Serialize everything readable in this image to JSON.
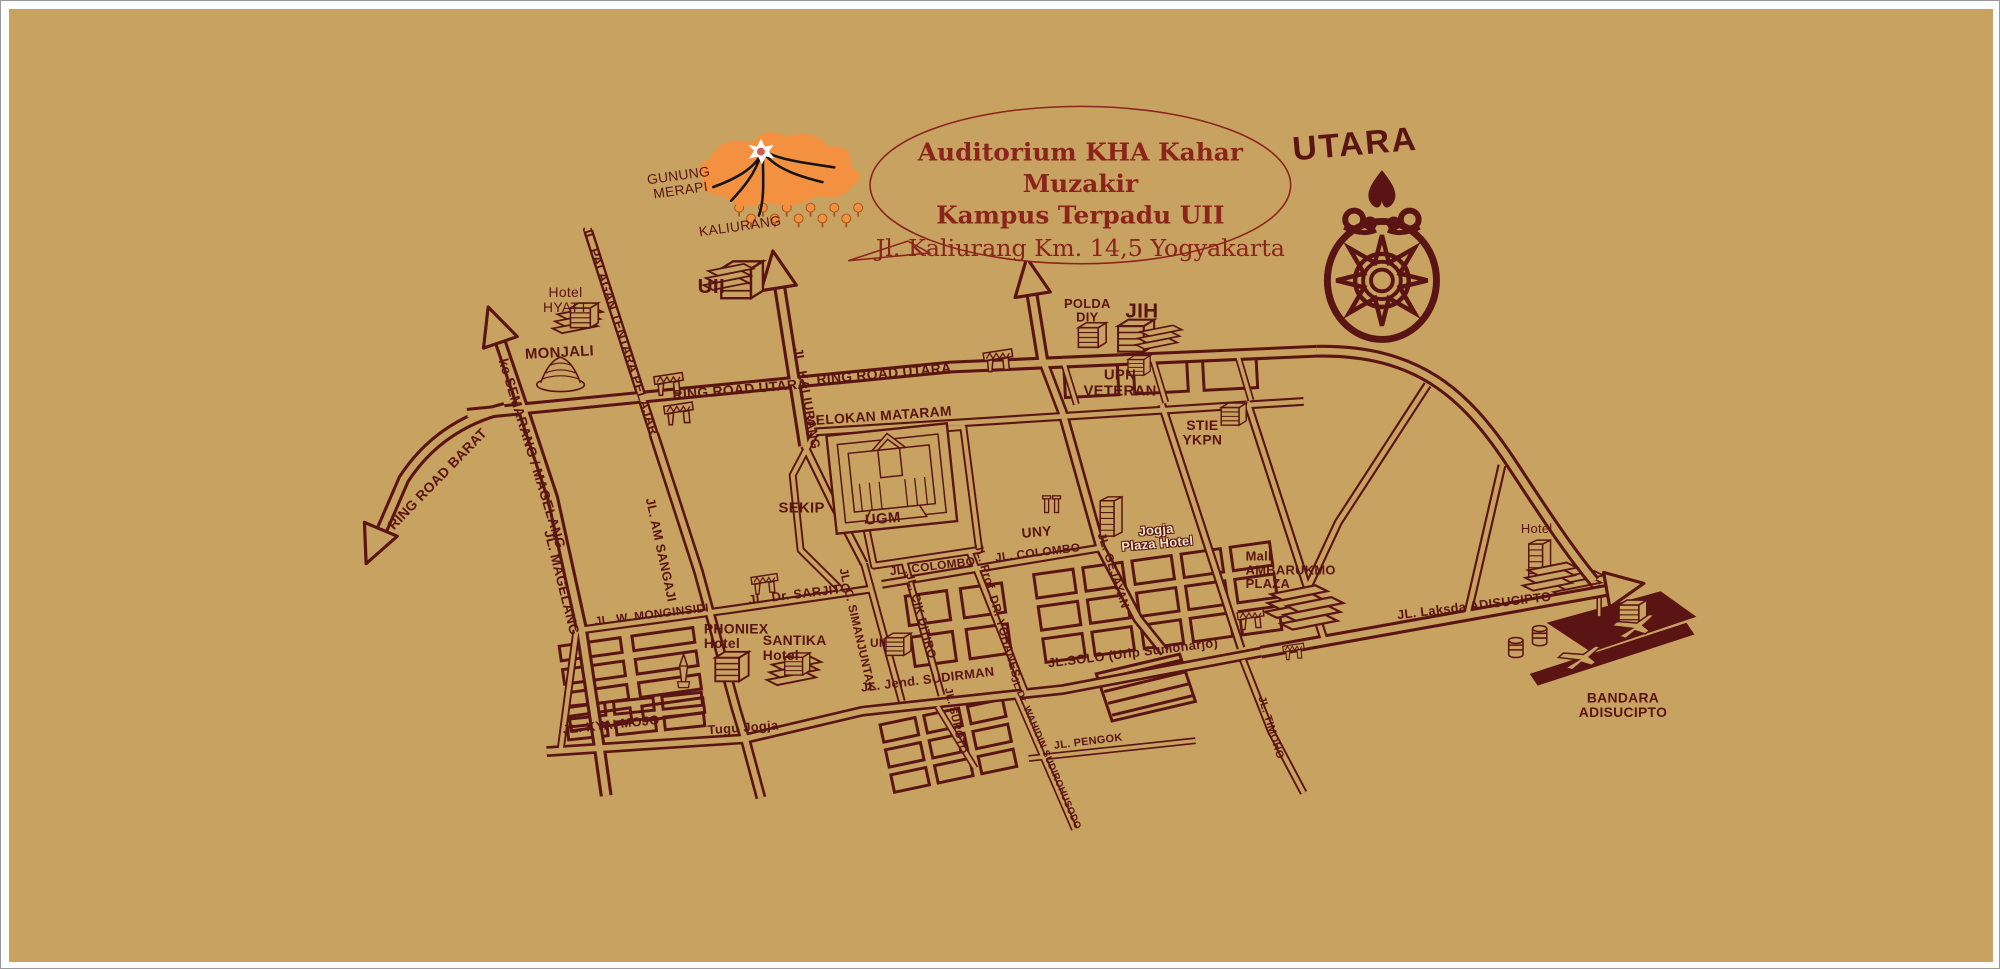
{
  "map": {
    "colors": {
      "background": "#c8a260",
      "ink": "#5a1413",
      "title": "#8c231c",
      "volcano_orange": "#f49140",
      "tree_trunk": "#a8541c",
      "lava_black": "#151515",
      "crater_red": "#d85757",
      "crater_white": "#ffffff",
      "plaza_label": "#f2e6c9",
      "frame_white": "#ffffff"
    },
    "balloon": {
      "line1": "Auditorium KHA Kahar Muzakir",
      "line2": "Kampus Terpadu UII",
      "line3": "Jl. Kaliurang Km. 14,5 Yogyakarta"
    },
    "compass": {
      "label": "UTARA"
    },
    "labels": [
      {
        "id": "gunung-merapi",
        "text": "GUNUNG\nMERAPI",
        "x": 676,
        "y": 177,
        "rot": -8,
        "fs": 14,
        "b": 0
      },
      {
        "id": "kaliurang",
        "text": "KALIURANG",
        "x": 737,
        "y": 221,
        "rot": -8,
        "fs": 14,
        "b": 0
      },
      {
        "id": "uii-north",
        "text": "UII",
        "x": 708,
        "y": 283,
        "rot": 0,
        "fs": 21,
        "b": 1
      },
      {
        "id": "hotel-hyatt",
        "text": "Hotel\nHYATT",
        "x": 561,
        "y": 296,
        "rot": 0,
        "fs": 14,
        "b": 0
      },
      {
        "id": "monjali",
        "text": "MONJALI",
        "x": 555,
        "y": 350,
        "rot": -3,
        "fs": 15,
        "b": 1
      },
      {
        "id": "ke-semarang-magelang",
        "text": "ke  SEMARANG / MAGELANG",
        "x": 527,
        "y": 452,
        "rot": 73,
        "fs": 14,
        "b": 1
      },
      {
        "id": "jl-palagan-tentara-pelajar",
        "text": "JL. PALAGAN TENTARA PELAJAR",
        "x": 616,
        "y": 327,
        "rot": 72,
        "fs": 13,
        "b": 1
      },
      {
        "id": "ring-road-barat",
        "text": "RING ROAD BARAT",
        "x": 432,
        "y": 478,
        "rot": -46,
        "fs": 14,
        "b": 1
      },
      {
        "id": "jl-magelang",
        "text": "JL. MAGELANG",
        "x": 557,
        "y": 583,
        "rot": 76,
        "fs": 14,
        "b": 1
      },
      {
        "id": "ring-road-utara-west",
        "text": "RING ROAD UTARA",
        "x": 737,
        "y": 387,
        "rot": -5,
        "fs": 14,
        "b": 1
      },
      {
        "id": "ring-road-utara-east",
        "text": "RING ROAD UTARA",
        "x": 882,
        "y": 371,
        "rot": -5,
        "fs": 14,
        "b": 1
      },
      {
        "id": "jl-kaliurang",
        "text": "JL. KALIURANG",
        "x": 804,
        "y": 396,
        "rot": 80,
        "fs": 13,
        "b": 1
      },
      {
        "id": "selokan-mataram",
        "text": "SELOKAN MATARAM",
        "x": 877,
        "y": 414,
        "rot": -4,
        "fs": 14,
        "b": 1
      },
      {
        "id": "polda-diy",
        "text": "POLDA\nDIY",
        "x": 1087,
        "y": 307,
        "rot": 0,
        "fs": 13,
        "b": 1
      },
      {
        "id": "jih",
        "text": "JIH",
        "x": 1142,
        "y": 308,
        "rot": 0,
        "fs": 21,
        "b": 1
      },
      {
        "id": "upn-veteran",
        "text": "UPN\nVETERAN",
        "x": 1120,
        "y": 381,
        "rot": 0,
        "fs": 15,
        "b": 1
      },
      {
        "id": "stie-ykpn",
        "text": "STIE\nYKPN",
        "x": 1203,
        "y": 431,
        "rot": 0,
        "fs": 14,
        "b": 1
      },
      {
        "id": "sekip",
        "text": "SEKIP",
        "x": 799,
        "y": 508,
        "rot": 0,
        "fs": 15,
        "b": 1
      },
      {
        "id": "ugm",
        "text": "UGM",
        "x": 881,
        "y": 519,
        "rot": -5,
        "fs": 15,
        "b": 1
      },
      {
        "id": "uny",
        "text": "UNY",
        "x": 1036,
        "y": 532,
        "rot": -5,
        "fs": 14,
        "b": 1
      },
      {
        "id": "jogja-plaza-hotel",
        "text": "Jogja\nPlaza Hotel",
        "x": 1157,
        "y": 537,
        "rot": -5,
        "fs": 13,
        "b": 1,
        "c": "plaza"
      },
      {
        "id": "jl-colombo-west",
        "text": "JL. COLOMBO",
        "x": 931,
        "y": 567,
        "rot": -7,
        "fs": 12,
        "b": 1
      },
      {
        "id": "jl-colombo-east",
        "text": "JL. COLOMBO",
        "x": 1037,
        "y": 553,
        "rot": -7,
        "fs": 12,
        "b": 1
      },
      {
        "id": "jl-prof-dr-yohanes",
        "text": "JL. Prof. DR. YOHANES",
        "x": 996,
        "y": 612,
        "rot": 74,
        "fs": 12,
        "b": 1
      },
      {
        "id": "jl-cik-ditiro",
        "text": "JL. CIK DITIRO",
        "x": 919,
        "y": 617,
        "rot": 75,
        "fs": 12,
        "b": 1
      },
      {
        "id": "jl-c-simanjuntak",
        "text": "JL. C. SIMANJUNTAK",
        "x": 855,
        "y": 631,
        "rot": 77,
        "fs": 12,
        "b": 1
      },
      {
        "id": "jl-gejayan",
        "text": "JL. GEJAYAN",
        "x": 1113,
        "y": 571,
        "rot": 72,
        "fs": 12,
        "b": 1
      },
      {
        "id": "mall-ambarukmo-plaza",
        "text": "Mall\nAMBARUKMO\nPLAZA",
        "x": 1292,
        "y": 571,
        "rot": 0,
        "fs": 13,
        "b": 1,
        "align": "left"
      },
      {
        "id": "jl-laksda-adisucipto",
        "text": "JL. Laksda ADISUCIPTO",
        "x": 1477,
        "y": 607,
        "rot": -7,
        "fs": 13,
        "b": 1
      },
      {
        "id": "hotel-east",
        "text": "Hotel",
        "x": 1540,
        "y": 529,
        "rot": 0,
        "fs": 13,
        "b": 0
      },
      {
        "id": "bandara-adisucipto",
        "text": "BANDARA\nADISUCIPTO",
        "x": 1627,
        "y": 708,
        "rot": 0,
        "fs": 14,
        "b": 1
      },
      {
        "id": "jl-w-monginsidi",
        "text": "JL. W. MONGINSIDI",
        "x": 648,
        "y": 616,
        "rot": -7,
        "fs": 12,
        "b": 1
      },
      {
        "id": "jl-dr-sarjito",
        "text": "JL. Dr. SARJITO",
        "x": 797,
        "y": 595,
        "rot": -7,
        "fs": 13,
        "b": 1
      },
      {
        "id": "phoniex-hotel",
        "text": "PHONIEX\nHotel",
        "x": 733,
        "y": 638,
        "rot": 0,
        "fs": 14,
        "b": 1,
        "align": "left"
      },
      {
        "id": "santika-hotel",
        "text": "SANTIKA\nHotel",
        "x": 792,
        "y": 650,
        "rot": 0,
        "fs": 14,
        "b": 1,
        "align": "left"
      },
      {
        "id": "uii-south",
        "text": "UII",
        "x": 876,
        "y": 645,
        "rot": 0,
        "fs": 12,
        "b": 1
      },
      {
        "id": "jl-am-sangaji",
        "text": "JL. AM SANGAJI",
        "x": 657,
        "y": 550,
        "rot": 78,
        "fs": 13,
        "b": 1
      },
      {
        "id": "jl-jend-sudirman",
        "text": "JL. Jend. SUDIRMAN",
        "x": 926,
        "y": 682,
        "rot": -7,
        "fs": 13,
        "b": 1
      },
      {
        "id": "jl-solo-urip-sumoharjo",
        "text": "JL.SOLO (Urip Sumoharjo)",
        "x": 1133,
        "y": 655,
        "rot": -7,
        "fs": 13,
        "b": 1
      },
      {
        "id": "jl-kyai-mojo",
        "text": "JL. KYAI MOJO",
        "x": 607,
        "y": 728,
        "rot": -6,
        "fs": 13,
        "b": 1
      },
      {
        "id": "tugu-jogja",
        "text": "Tugu Jogja",
        "x": 740,
        "y": 731,
        "rot": -4,
        "fs": 13,
        "b": 1
      },
      {
        "id": "jl-suroto",
        "text": "JL. SUROTO",
        "x": 953,
        "y": 724,
        "rot": 77,
        "fs": 11,
        "b": 1
      },
      {
        "id": "jl-pengok",
        "text": "JL. PENGOK",
        "x": 1088,
        "y": 746,
        "rot": -7,
        "fs": 11,
        "b": 1
      },
      {
        "id": "jl-dr-wahidin-sudirohusodo",
        "text": "JL.Dr. WAHIDIN SUDIROHUSODO",
        "x": 1044,
        "y": 757,
        "rot": 67,
        "fs": 10,
        "b": 1
      },
      {
        "id": "jl-timoho",
        "text": "JL. TIMOHO",
        "x": 1271,
        "y": 731,
        "rot": 73,
        "fs": 11,
        "b": 1
      }
    ]
  }
}
